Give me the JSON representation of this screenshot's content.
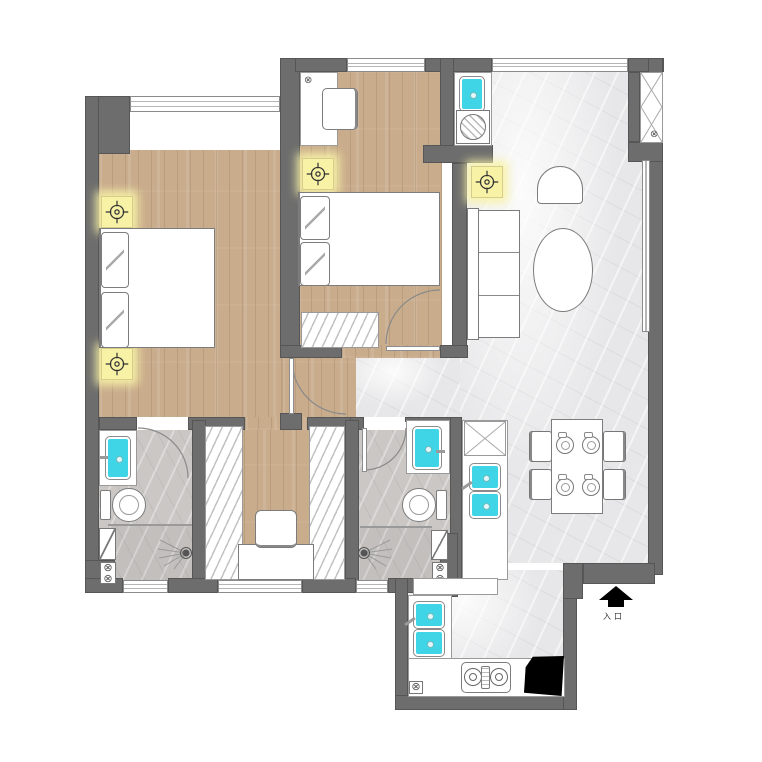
{
  "plan": {
    "kind": "apartment-floor-plan",
    "entrance": {
      "label": "入口"
    },
    "glyphs": {
      "valve": "⊗"
    },
    "colors": {
      "wall": "#6d6d6d",
      "wood_floor": "#c9ac8c",
      "marble_floor": "#e7e7e9",
      "tile_floor": "#cac7c4",
      "fixture_cyan": "#3fd4e6",
      "light_yellow": "#f8f2a6",
      "appliance_black": "#000000"
    },
    "fixtures": [
      "ceiling-light",
      "double-bed",
      "desk-chair",
      "wardrobe-rail",
      "sofa",
      "armchair",
      "coffee-table",
      "dining-table",
      "dining-chair",
      "place-setting",
      "toilet",
      "basin",
      "shower-drain",
      "washing-machine",
      "gas-stove",
      "kitchen-sink",
      "water-heater",
      "shoe-cabinet",
      "entrance-arrow"
    ]
  }
}
